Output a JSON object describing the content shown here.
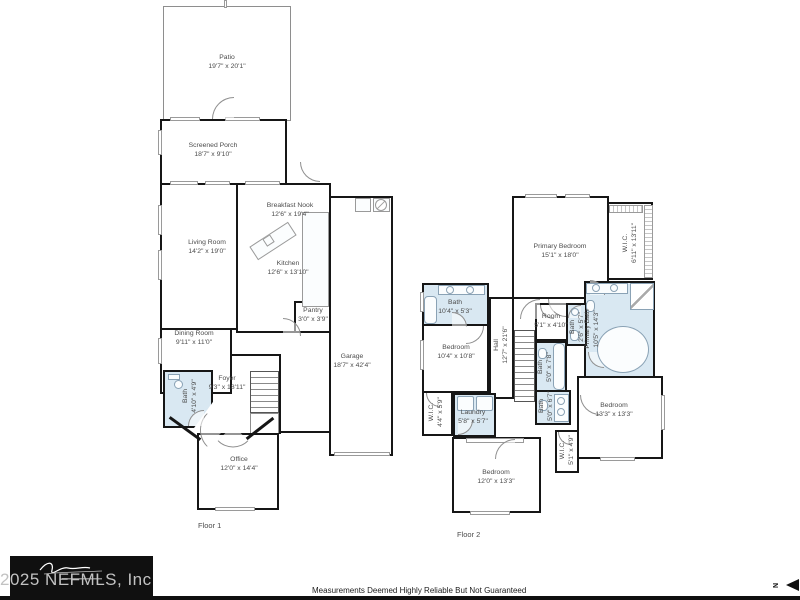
{
  "meta": {
    "watermark": "2025 NEFMLS, Inc",
    "disclaimer": "Measurements Deemed Highly Reliable But Not Guaranteed",
    "north_label": "N",
    "north_icon": "left-pointing-triangle"
  },
  "colors": {
    "wall": "#161616",
    "bath_fill": "#d9e8f2",
    "label_text": "#4c4c4c",
    "fixture_line": "#9a9a9a"
  },
  "floor1": {
    "label": "Floor 1",
    "rooms": [
      {
        "name": "Patio",
        "dims": "19'7\" x 20'1\""
      },
      {
        "name": "Screened Porch",
        "dims": "18'7\" x 9'10\""
      },
      {
        "name": "Breakfast Nook",
        "dims": "12'6\" x 19'4\""
      },
      {
        "name": "Living Room",
        "dims": "14'2\" x 19'0\""
      },
      {
        "name": "Kitchen",
        "dims": "12'6\" x 13'10\""
      },
      {
        "name": "Pantry",
        "dims": "3'0\" x 3'9\""
      },
      {
        "name": "Dining Room",
        "dims": "9'11\" x 11'0\""
      },
      {
        "name": "Garage",
        "dims": "18'7\" x 42'4\""
      },
      {
        "name": "Foyer",
        "dims": "9'3\" x 18'11\""
      },
      {
        "name": "Bath",
        "dims": "4'10\" x 4'9\""
      },
      {
        "name": "Office",
        "dims": "12'0\" x 14'4\""
      }
    ]
  },
  "floor2": {
    "label": "Floor 2",
    "rooms": [
      {
        "name": "Primary Bedroom",
        "dims": "15'1\" x 18'0\""
      },
      {
        "name": "W.I.C.",
        "dims": "6'11\" x 13'11\""
      },
      {
        "name": "Primary Bath",
        "dims": "10'5\" x 14'3\""
      },
      {
        "name": "Bath",
        "dims": "10'4\" x 5'3\""
      },
      {
        "name": "Bedroom",
        "dims": "10'4\" x 10'8\""
      },
      {
        "name": "Hall",
        "dims": "12'7\" x 21'6\""
      },
      {
        "name": "Room",
        "dims": "5'1\" x 4'10\""
      },
      {
        "name": "Bath",
        "dims": "2'6\" x 5'7\""
      },
      {
        "name": "Bath",
        "dims": "5'0\" x 7'8\""
      },
      {
        "name": "Bath",
        "dims": "5'0\" x 6'7\""
      },
      {
        "name": "W.I.C.",
        "dims": "4'4\" x 5'9\""
      },
      {
        "name": "Laundry",
        "dims": "5'8\" x 5'7\""
      },
      {
        "name": "Bedroom",
        "dims": "12'0\" x 13'3\""
      },
      {
        "name": "W.I.C.",
        "dims": "5'1\" x 4'9\""
      },
      {
        "name": "Bedroom",
        "dims": "13'3\" x 13'3\""
      }
    ]
  }
}
